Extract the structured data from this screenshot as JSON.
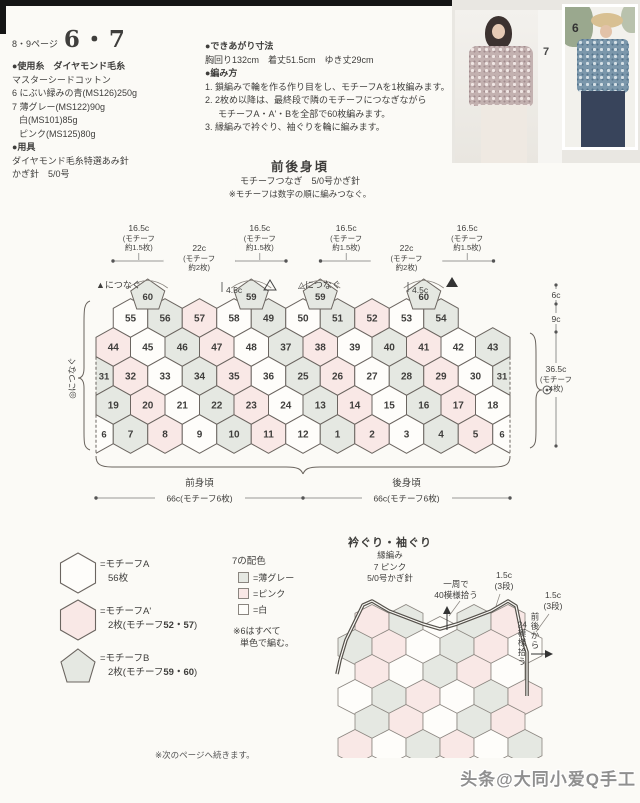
{
  "page": {
    "page_ref": "8・9ページ",
    "title": "6・7"
  },
  "materials": {
    "use_yarn_header": "●使用糸　ダイヤモンド毛糸",
    "lines": [
      "マスターシードコットン",
      "6 にぶい緑みの青(MS126)250g",
      "7 薄グレー(MS122)90g",
      "白(MS101)85g",
      "ピンク(MS125)80g"
    ],
    "tools_header": "●用具",
    "tools": [
      "ダイヤモンド毛糸特選あみ針",
      "かぎ針　5/0号"
    ]
  },
  "size": {
    "header": "●できあがり寸法",
    "text": "胸回り132cm　着丈51.5cm　ゆき丈29cm"
  },
  "howto": {
    "header": "●編み方",
    "steps": [
      "1. 鎖編みで輪を作る作り目をし、モチーフAを1枚編みます。",
      "2. 2枚め以降は、最終段で隣のモチーフにつなぎながら",
      "モチーフA・A'・Bを全部で60枚編みます。",
      "3. 縁編みで衿ぐり、袖ぐりを輪に編みます。"
    ]
  },
  "photos": {
    "label_left": "7",
    "label_right": "6"
  },
  "diagram": {
    "title": "前後身頃",
    "subtitle": "モチーフつなぎ　5/0号かぎ針",
    "note": "※モチーフは数字の順に編みつなぐ。",
    "colors": {
      "W": "#fefdfa",
      "G": "#e5e8e2",
      "P": "#f9e8e6",
      "line": "#6b6560"
    },
    "top_measures": [
      {
        "len": "16.5c",
        "sub1": "(モチーフ",
        "sub2": "約1.5枚)"
      },
      {
        "len": "22c",
        "sub1": "(モチーフ",
        "sub2": "約2枚)"
      },
      {
        "len": "16.5c",
        "sub1": "(モチーフ",
        "sub2": "約1.5枚)"
      },
      {
        "len": "16.5c",
        "sub1": "(モチーフ",
        "sub2": "約1.5枚)"
      },
      {
        "len": "22c",
        "sub1": "(モチーフ",
        "sub2": "約2枚)"
      },
      {
        "len": "16.5c",
        "sub1": "(モチーフ",
        "sub2": "約1.5枚)"
      }
    ],
    "marks": {
      "join_left": "▲につなぐ",
      "neck_left": "4.5c",
      "join_mid": "△につなぐ",
      "neck_right": "4.5c",
      "left_edge_join": "◎につなぐ"
    },
    "side_measures": {
      "m1": "6c",
      "m2": "9c",
      "m3": "36.5c",
      "m3sub1": "(モチーフ",
      "m3sub2": "4枚)"
    },
    "bottom": {
      "front": "前身頃",
      "back": "後身頃",
      "w1": "66c(モチーフ6枚)",
      "w2": "66c(モチーフ6枚)"
    },
    "pentagons": [
      [
        "60",
        "G"
      ],
      [
        "59",
        "G"
      ],
      [
        "59",
        "G"
      ],
      [
        "60",
        "G"
      ]
    ],
    "rows": [
      [
        [
          "55",
          "W"
        ],
        [
          "56",
          "G"
        ],
        [
          "57",
          "P"
        ],
        [
          "58",
          "W"
        ],
        [
          "49",
          "G"
        ],
        [
          "50",
          "W"
        ],
        [
          "51",
          "G"
        ],
        [
          "52",
          "P"
        ],
        [
          "53",
          "W"
        ],
        [
          "54",
          "G"
        ]
      ],
      [
        [
          "44",
          "P"
        ],
        [
          "45",
          "W"
        ],
        [
          "46",
          "G"
        ],
        [
          "47",
          "P"
        ],
        [
          "48",
          "W"
        ],
        [
          "37",
          "G"
        ],
        [
          "38",
          "P"
        ],
        [
          "39",
          "W"
        ],
        [
          "40",
          "G"
        ],
        [
          "41",
          "P"
        ],
        [
          "42",
          "W"
        ],
        [
          "43",
          "G"
        ]
      ],
      [
        [
          "31",
          "G"
        ],
        [
          "32",
          "P"
        ],
        [
          "33",
          "W"
        ],
        [
          "34",
          "G"
        ],
        [
          "35",
          "P"
        ],
        [
          "36",
          "W"
        ],
        [
          "25",
          "G"
        ],
        [
          "26",
          "P"
        ],
        [
          "27",
          "W"
        ],
        [
          "28",
          "G"
        ],
        [
          "29",
          "P"
        ],
        [
          "30",
          "W"
        ],
        [
          "31",
          "G"
        ]
      ],
      [
        [
          "19",
          "G"
        ],
        [
          "20",
          "P"
        ],
        [
          "21",
          "W"
        ],
        [
          "22",
          "G"
        ],
        [
          "23",
          "P"
        ],
        [
          "24",
          "W"
        ],
        [
          "13",
          "G"
        ],
        [
          "14",
          "P"
        ],
        [
          "15",
          "W"
        ],
        [
          "16",
          "G"
        ],
        [
          "17",
          "P"
        ],
        [
          "18",
          "W"
        ]
      ],
      [
        [
          "6",
          "W"
        ],
        [
          "7",
          "G"
        ],
        [
          "8",
          "P"
        ],
        [
          "9",
          "W"
        ],
        [
          "10",
          "G"
        ],
        [
          "11",
          "P"
        ],
        [
          "12",
          "W"
        ],
        [
          "1",
          "G"
        ],
        [
          "2",
          "P"
        ],
        [
          "3",
          "W"
        ],
        [
          "4",
          "G"
        ],
        [
          "5",
          "P"
        ],
        [
          "6",
          "W"
        ]
      ]
    ]
  },
  "legend": {
    "items": [
      {
        "shape": "hexagon",
        "fill": "W",
        "name": "=モチーフA",
        "count_prefix": "56枚",
        "count_bold": "",
        "count_suffix": ""
      },
      {
        "shape": "hexagon",
        "fill": "P",
        "name": "=モチーフA'",
        "count_prefix": "2枚(モチーフ",
        "count_bold": "52・57",
        "count_suffix": ")"
      },
      {
        "shape": "pentagon",
        "fill": "G",
        "name": "=モチーフB",
        "count_prefix": "2枚(モチーフ",
        "count_bold": "59・60",
        "count_suffix": ")"
      }
    ]
  },
  "colorkey": {
    "title": "7の配色",
    "items": [
      {
        "swatch": "G",
        "label": "=薄グレー"
      },
      {
        "swatch": "P",
        "label": "=ピンク"
      },
      {
        "swatch": "W",
        "label": "=白"
      }
    ],
    "note1": "※6はすべて",
    "note2": "単色で編む。"
  },
  "neck": {
    "title": "衿ぐり・袖ぐり",
    "sub1": "縁編み",
    "sub2": "7 ピンク",
    "sub3": "5/0号かぎ針",
    "pickup1": "一周で",
    "pickup2": "40模様拾う",
    "edge1a": "1.5c",
    "edge1b": "(3段)",
    "edge2a": "1.5c",
    "edge2b": "(3段)",
    "side_v1": "前後から",
    "side_v2a": "24",
    "side_v2b": "模様拾う",
    "rows": [
      [
        "P",
        "G",
        "W",
        "G",
        "P"
      ],
      [
        "G",
        "P",
        "W",
        "G",
        "P",
        "W"
      ],
      [
        "P",
        "W",
        "G",
        "P",
        "W"
      ],
      [
        "W",
        "G",
        "P",
        "W",
        "G",
        "P"
      ],
      [
        "G",
        "P",
        "W",
        "G",
        "P"
      ],
      [
        "P",
        "W",
        "G",
        "P",
        "W",
        "G"
      ]
    ]
  },
  "footer": {
    "next": "※次のページへ続きます。",
    "watermark": "头条@大同小爱Q手工"
  }
}
